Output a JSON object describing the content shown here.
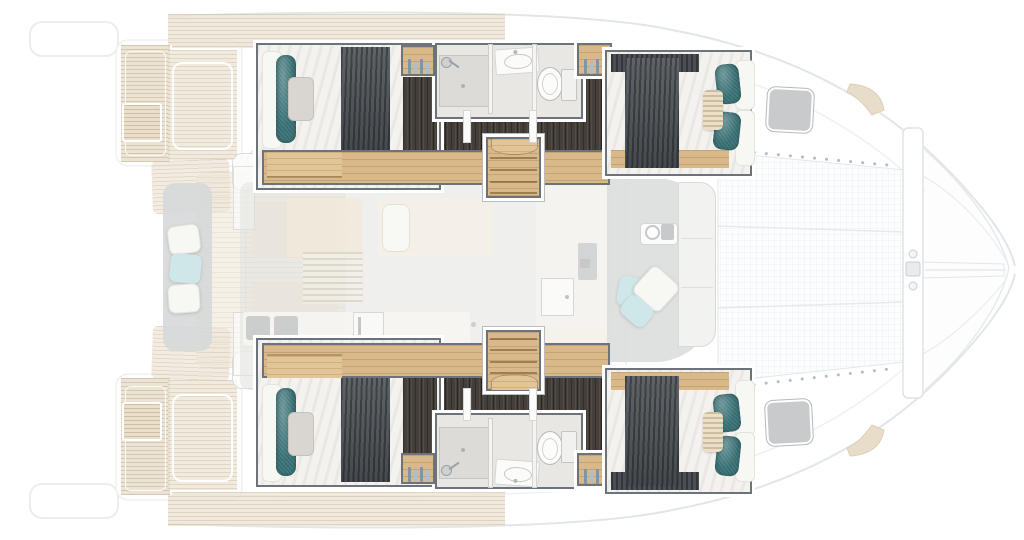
{
  "image_type": "Catamaran yacht accommodation floor plan (top-down 3D render); four-cabin layout; no visible text in image",
  "labels": {
    "plan": "Catamaran 4-cabin floor plan",
    "bow": "Bow with trampoline, crossbeam and bowsprit",
    "stern": "Stern with swim platforms and aft cockpit",
    "salon": "Salon with galley, daybed and lockers",
    "fwd_cockpit": "Forward cockpit with bench, cushions and windlass",
    "port_hull": "Port hull (top): aft double cabin, bathroom, stairs, forward double cabin",
    "stbd_hull": "Starboard hull (bottom): aft double cabin, bathroom, stairs, forward double cabin",
    "port_aft_cabin": "Port aft double cabin",
    "port_bathroom": "Port bathroom: shower, sink, toilet",
    "port_fwd_cabin": "Port forward double cabin",
    "stbd_aft_cabin": "Starboard aft double cabin",
    "stbd_bathroom": "Starboard bathroom: shower, sink, toilet",
    "stbd_fwd_cabin": "Starboard forward double cabin"
  },
  "features": {
    "hulls": [
      "double-berth",
      "teal-bolster-pillow",
      "gray-pillow",
      "dark-duvet",
      "wood-shelf",
      "dark-wood-corridor",
      "companionway-stairs",
      "bottle-locker",
      "wardrobe",
      "cabin-door"
    ],
    "bathrooms": [
      "shower-tray",
      "shower-head",
      "glass-partition",
      "vanity-sink",
      "toilet"
    ],
    "salon": [
      "galley-counter",
      "appliances",
      "fridge",
      "faucet",
      "chaise-daybed",
      "louvered-locker",
      "sliding-door",
      "forward-door"
    ],
    "aft_cockpit": [
      "bench-seat",
      "seat-cushions",
      "cockpit-tables",
      "teak-sole",
      "swim-platform",
      "transom-step",
      "side-deck"
    ],
    "foredeck": [
      "forward-bench",
      "scatter-cushions",
      "windlass",
      "deck-hatch",
      "trampoline-mesh",
      "crossbeam",
      "bowsprit",
      "lashing-dots",
      "anchor-roller-pad"
    ]
  },
  "palette": {
    "background": "#ffffff",
    "hull_line": "#e2e6e9",
    "deck_teak": "#ece3d3",
    "cream": "#f1eadb",
    "bench_gray": "#d6d8d9",
    "pillow_blue": "#cfe7e8",
    "pillow_gray": "#d9d5d0",
    "wall_dark": "#6d737a",
    "wood": "#d9b98a",
    "floor_dark": "#453f39",
    "linen": "#f3f2ef",
    "duvet": "#4c5257",
    "teal": "#417a7e",
    "bath_floor": "#e8e7e4",
    "shower_tray": "#dcdbd8",
    "hatch_gray": "#c9cacb"
  }
}
